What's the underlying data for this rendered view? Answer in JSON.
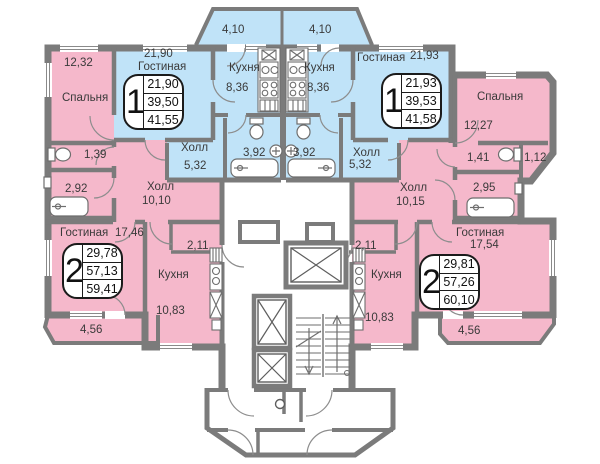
{
  "colors": {
    "apartment_pink": "#f5b8cb",
    "apartment_blue": "#c0e3f8",
    "wall_gray": "#7b7b7b",
    "text": "#3a3a3a"
  },
  "apartments": {
    "one_left": {
      "type": "1",
      "stats": {
        "living": "21,90",
        "usable": "39,50",
        "total": "41,55"
      },
      "rooms": {
        "living": {
          "label": "Гостиная",
          "area": "21,90"
        },
        "kitchen": {
          "label": "Кухня",
          "area": "8,36"
        },
        "hall": {
          "label": "Холл",
          "area": "5,32"
        },
        "bath": {
          "area": "3,92"
        },
        "balcony": {
          "area": "4,10"
        }
      }
    },
    "one_right": {
      "type": "1",
      "stats": {
        "living": "21,93",
        "usable": "39,53",
        "total": "41,58"
      },
      "rooms": {
        "living": {
          "label": "Гостиная",
          "area": "21,93"
        },
        "kitchen": {
          "label": "Кухня",
          "area": "8,36"
        },
        "hall": {
          "label": "Холл",
          "area": "5,32"
        },
        "bath": {
          "area": "3,92"
        },
        "balcony": {
          "area": "4,10"
        }
      }
    },
    "two_left": {
      "type": "2",
      "stats": {
        "living": "29,78",
        "usable": "57,13",
        "total": "59,41"
      },
      "rooms": {
        "bedroom": {
          "label": "Спальня",
          "area": "12,32"
        },
        "wc": {
          "area": "1,39"
        },
        "bath": {
          "area": "2,92"
        },
        "hall": {
          "label": "Холл",
          "area": "10,10"
        },
        "living": {
          "label": "Гостиная",
          "area": "17,46"
        },
        "closet": {
          "area": "2,11"
        },
        "kitchen": {
          "label": "Кухня",
          "area": "10,83"
        },
        "balcony": {
          "area": "4,56"
        }
      }
    },
    "two_right": {
      "type": "2",
      "stats": {
        "living": "29,81",
        "usable": "57,26",
        "total": "60,10"
      },
      "rooms": {
        "bedroom": {
          "label": "Спальня",
          "area": "12,27"
        },
        "wc": {
          "area": "1,41"
        },
        "storage": {
          "area": "1,12"
        },
        "bath": {
          "area": "2,95"
        },
        "hall": {
          "label": "Холл",
          "area": "10,15"
        },
        "living": {
          "label": "Гостиная",
          "area": "17,54"
        },
        "closet": {
          "area": "2,11"
        },
        "kitchen": {
          "label": "Кухня",
          "area": "10,83"
        },
        "balcony": {
          "area": "4,56"
        }
      }
    }
  }
}
